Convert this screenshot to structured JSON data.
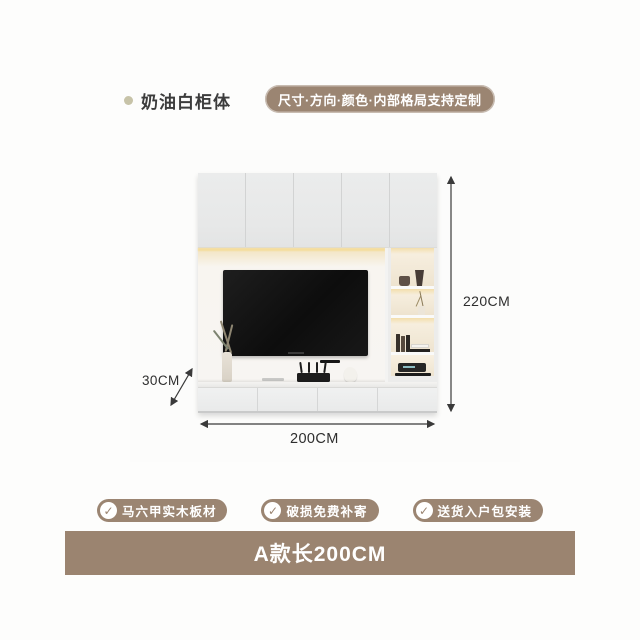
{
  "header": {
    "series_label": "奶油白柜体",
    "customize_note": "尺寸·方向·颜色·内部格局支持定制"
  },
  "product": {
    "height_label": "220CM",
    "width_label": "200CM",
    "depth_label": "30CM"
  },
  "icons": {
    "check": "✓",
    "bullet": "dot"
  },
  "features": [
    {
      "label": "马六甲实木板材"
    },
    {
      "label": "破损免费补寄"
    },
    {
      "label": "送货入户包安装"
    }
  ],
  "footer": {
    "variant_label": "A款长200CM"
  },
  "colors": {
    "accent_brown": "#9b8572",
    "bar_brown": "#9b8470",
    "bullet_beige": "#c7c3a8",
    "dimension_text": "#2e2e2e",
    "background": "#fdfdfc",
    "led_glow": "#f2e3bf",
    "tv_screen": "#111111"
  }
}
